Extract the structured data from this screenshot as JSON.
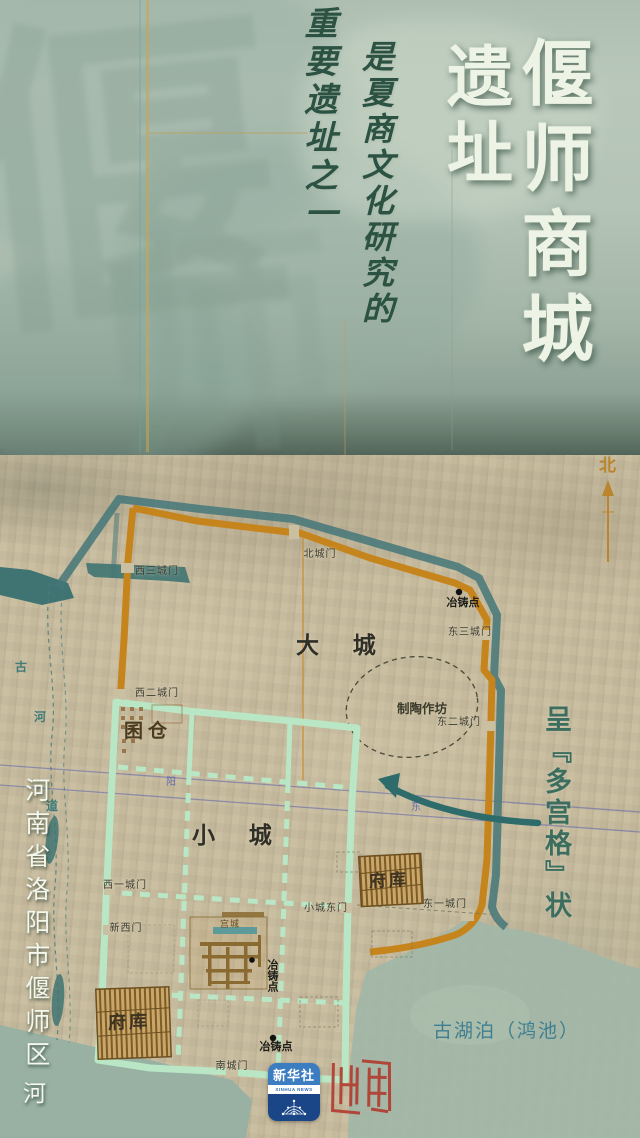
{
  "banner": {
    "title_main": "偃师商城",
    "title_sub": "遗址",
    "tagline_1": "是夏商文化研究的",
    "tagline_2": "重要遗址之一",
    "watermark_1": "偃",
    "watermark_2": "师"
  },
  "map": {
    "compass_north": "北",
    "labels": {
      "big_city": "大 城",
      "small_city": "小 城",
      "gate_west3": "西三城门",
      "gate_north": "北城门",
      "gate_east3": "东三城门",
      "gate_west2": "西二城门",
      "gate_east2": "东二城门",
      "gate_east1": "东一城门",
      "gate_west1": "西一城门",
      "gate_new_west": "新西门",
      "gate_small_east": "小城东门",
      "gate_south": "南城门",
      "casting_site_1": "冶铸点",
      "casting_site_2": "冶铸点",
      "casting_site_3": "冶铸点",
      "pottery_workshop": "制陶作坊",
      "granary": "囷仓",
      "treasury_upper": "府库",
      "treasury_lower": "府库",
      "palace_city": "宫城",
      "road_char_1": "阳",
      "road_char_2": "东"
    },
    "water_labels": {
      "ancient_river_1": "古",
      "ancient_river_2": "河",
      "ancient_river_3": "道",
      "river_bottom": "河",
      "ancient_lake": "古湖泊（鸿池）"
    },
    "annotation_right": "呈『多宫格』状",
    "annotation_left": "河南省洛阳市偃师区"
  },
  "footer": {
    "xinhua_cn": "新华社",
    "xinhua_en": "XINHUA NEWS"
  },
  "colors": {
    "wall_orange": "#c6851c",
    "moat_teal": "#447779",
    "small_city_green": "#b9e6c4",
    "annotation_teal": "#3c6e60",
    "lake_label_teal": "#3f7f91",
    "xinhua_blue": "#2a6cb5",
    "seal_red": "#b0392e"
  }
}
